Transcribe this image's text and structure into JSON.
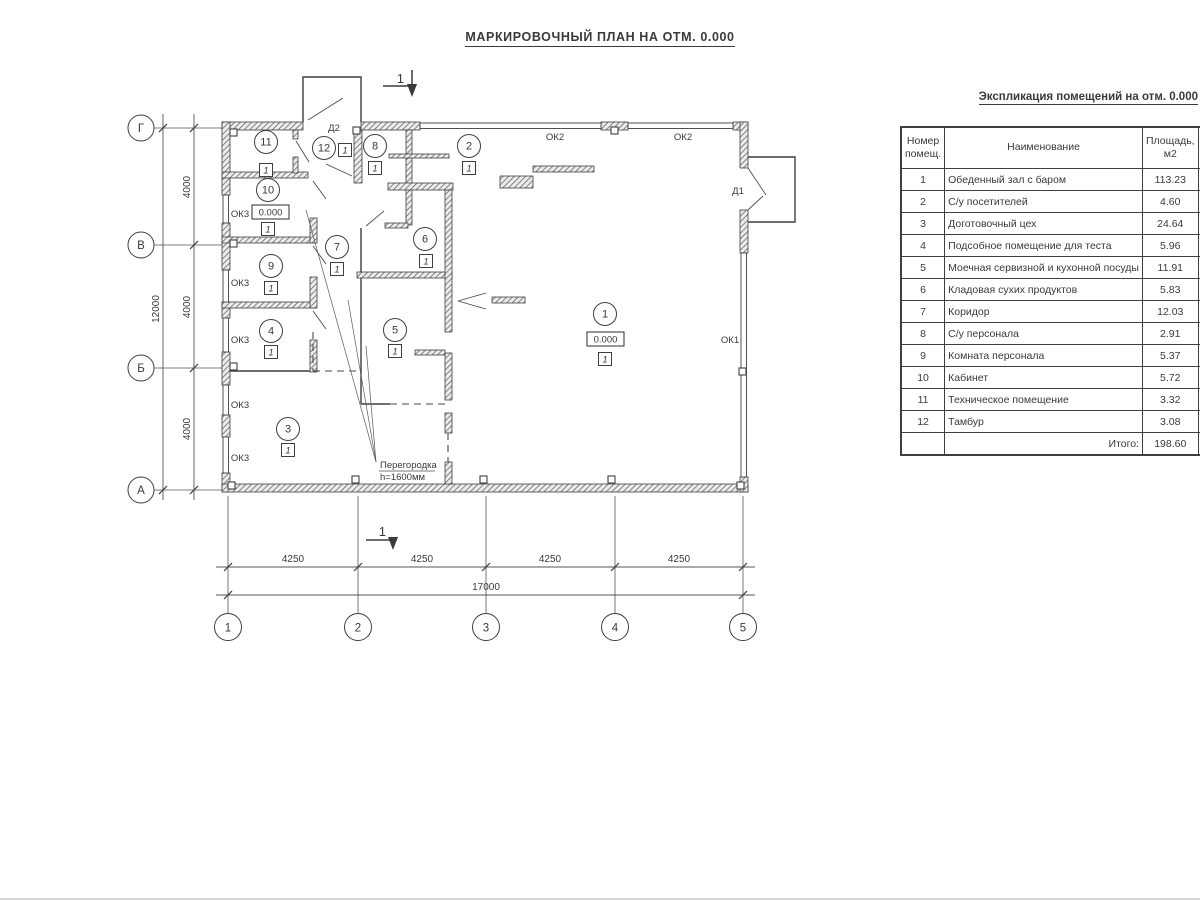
{
  "page": {
    "title": "МАРКИРОВОЧНЫЙ ПЛАН НА ОТМ. 0.000"
  },
  "plan": {
    "section_mark": "1",
    "elevation": "0.000",
    "floor_type": "1",
    "room_numbers": [
      "1",
      "2",
      "3",
      "4",
      "5",
      "6",
      "7",
      "8",
      "9",
      "10",
      "11",
      "12"
    ],
    "door_labels": {
      "d1": "Д1",
      "d2": "Д2"
    },
    "window_labels": {
      "ok1": "ОК1",
      "ok2": "ОК2",
      "ok3": "ОК3"
    },
    "partition_note": {
      "line1": "Перегородка",
      "line2": "h=1600мм"
    },
    "axes": {
      "bottom": [
        "1",
        "2",
        "3",
        "4",
        "5"
      ],
      "left": [
        "Г",
        "В",
        "Б",
        "А"
      ]
    },
    "dims": {
      "bottom_segments": [
        "4250",
        "4250",
        "4250",
        "4250"
      ],
      "bottom_total": "17000",
      "left_segments": [
        "4000",
        "4000",
        "4000"
      ],
      "left_total": "12000"
    }
  },
  "table": {
    "title": "Экспликация помещений на отм. 0.000",
    "headers": {
      "num_line1": "Номер",
      "num_line2": "помещ.",
      "name": "Наименование",
      "area_line1": "Площадь,",
      "area_line2": "м2",
      "cat_line1": "Ка",
      "cat_line2": "по"
    },
    "rows": [
      {
        "num": "1",
        "name": "Обеденный зал с баром",
        "area": "113.23"
      },
      {
        "num": "2",
        "name": "С/у посетителей",
        "area": "4.60"
      },
      {
        "num": "3",
        "name": "Доготовочный цех",
        "area": "24.64"
      },
      {
        "num": "4",
        "name": "Подсобное помещение для теста",
        "area": "5.96"
      },
      {
        "num": "5",
        "name": "Моечная сервизной и кухонной посуды",
        "area": "11.91"
      },
      {
        "num": "6",
        "name": "Кладовая сухих продуктов",
        "area": "5.83"
      },
      {
        "num": "7",
        "name": "Коридор",
        "area": "12.03"
      },
      {
        "num": "8",
        "name": "С/у персонала",
        "area": "2.91"
      },
      {
        "num": "9",
        "name": "Комната персонала",
        "area": "5.37"
      },
      {
        "num": "10",
        "name": "Кабинет",
        "area": "5.72"
      },
      {
        "num": "11",
        "name": "Техническое помещение",
        "area": "3.32"
      },
      {
        "num": "12",
        "name": "Тамбур",
        "area": "3.08"
      }
    ],
    "total_label": "Итого:",
    "total_value": "198.60"
  }
}
